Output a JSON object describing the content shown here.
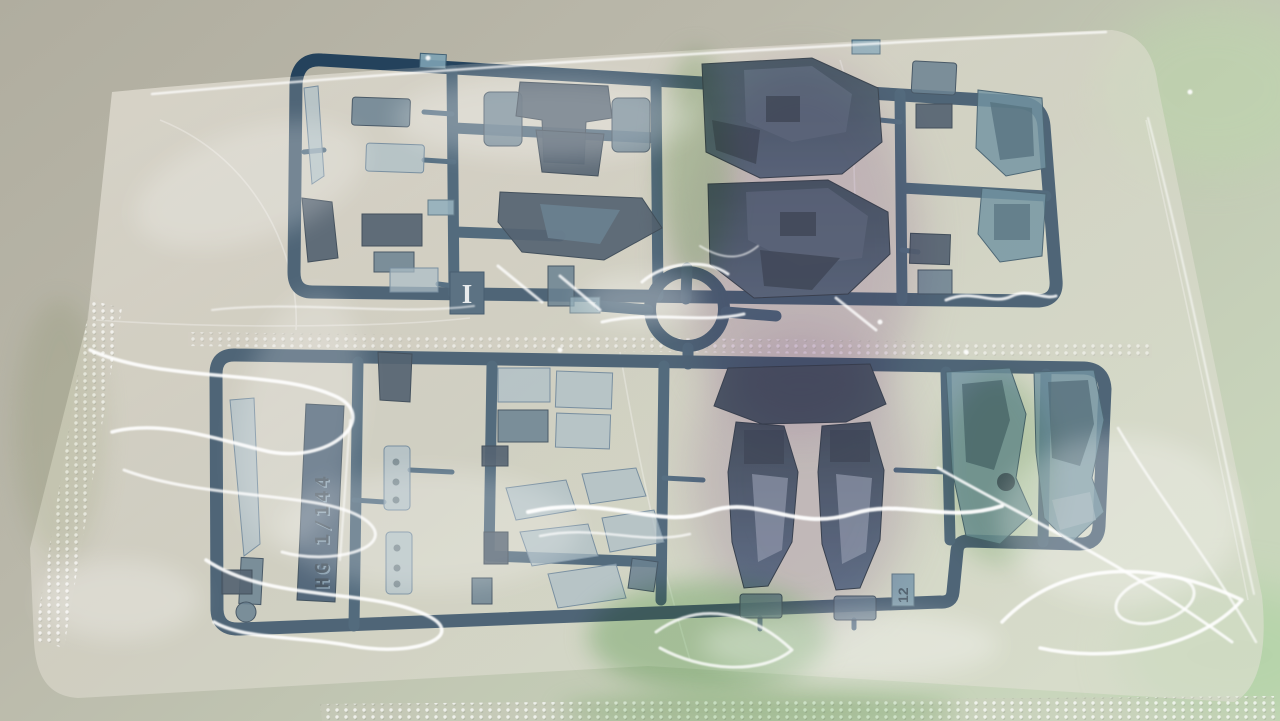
{
  "photo": {
    "subject": "Plastic model kit runner (sprue) with translucent smoky-blue parts sealed inside a clear plastic bag, lying on a desk",
    "lighting": "overhead light causing white specular swirls plus green and magenta reflections on the bag film"
  },
  "runner": {
    "embossed_text": "HG 1/144",
    "letter_tag": "I",
    "gate_tag": "12",
    "frame_color": "#24425c",
    "part_color_dark": "#2c4055",
    "part_color_mid": "#49677e",
    "part_color_light": "#9db4c2",
    "part_color_teal": "#527e93"
  },
  "bag": {
    "film_color": "#e8e4d8",
    "seal_texture": "crimped dotted seal bands (left edge, middle, bottom)",
    "highlight_color": "#ffffff",
    "tint_magenta": "#c9a6d4",
    "tint_green": "#8cc686"
  },
  "desk": {
    "color_top_left": "#b0ad9f",
    "color_bottom_right": "#c9d6bc"
  }
}
